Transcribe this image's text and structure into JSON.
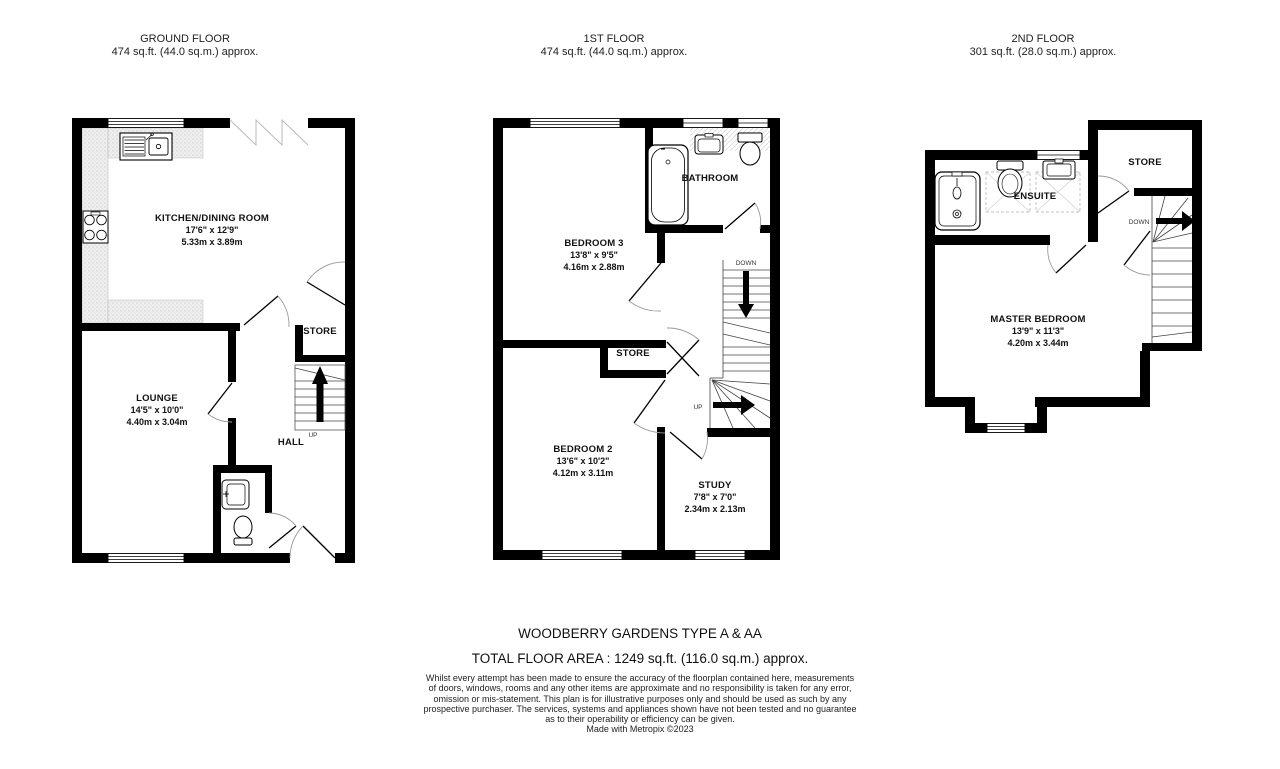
{
  "floors": [
    {
      "name": "GROUND FLOOR",
      "area": "474 sq.ft. (44.0 sq.m.) approx.",
      "labels": {
        "kitchen_name": "KITCHEN/DINING ROOM",
        "kitchen_imperial": "17'6\" x 12'9\"",
        "kitchen_metric": "5.33m x 3.89m",
        "lounge_name": "LOUNGE",
        "lounge_imperial": "14'5\" x 10'0\"",
        "lounge_metric": "4.40m x 3.04m",
        "store": "STORE",
        "hall": "HALL",
        "up": "UP"
      }
    },
    {
      "name": "1ST FLOOR",
      "area": "474 sq.ft. (44.0 sq.m.) approx.",
      "labels": {
        "bedroom3_name": "BEDROOM 3",
        "bedroom3_imperial": "13'8\" x 9'5\"",
        "bedroom3_metric": "4.16m x 2.88m",
        "bathroom": "BATHROOM",
        "store": "STORE",
        "bedroom2_name": "BEDROOM 2",
        "bedroom2_imperial": "13'6\" x 10'2\"",
        "bedroom2_metric": "4.12m x 3.11m",
        "study_name": "STUDY",
        "study_imperial": "7'8\" x 7'0\"",
        "study_metric": "2.34m x 2.13m",
        "down": "DOWN",
        "up": "UP"
      }
    },
    {
      "name": "2ND FLOOR",
      "area": "301 sq.ft. (28.0 sq.m.) approx.",
      "labels": {
        "store": "STORE",
        "ensuite": "ENSUITE",
        "master_name": "MASTER BEDROOM",
        "master_imperial": "13'9\" x 11'3\"",
        "master_metric": "4.20m x 3.44m",
        "down": "DOWN"
      }
    }
  ],
  "footer": {
    "title": "WOODBERRY GARDENS TYPE A & AA",
    "total_area": "TOTAL FLOOR AREA : 1249 sq.ft. (116.0 sq.m.) approx.",
    "disclaimer_lines": [
      "Whilst every attempt has been made to ensure the accuracy of the floorplan contained here, measurements",
      "of doors, windows, rooms and any other items are approximate and no responsibility is taken for any error,",
      "omission or mis-statement. This plan is for illustrative purposes only and should be used as such by any",
      "prospective purchaser. The services, systems and appliances shown have not been tested and no guarantee",
      "as to their operability or efficiency can be given."
    ],
    "credit": "Made with Metropix ©2023"
  },
  "colors": {
    "wall": "#000000",
    "counter": "#ededed",
    "door_arc": "#9a9a9a"
  }
}
